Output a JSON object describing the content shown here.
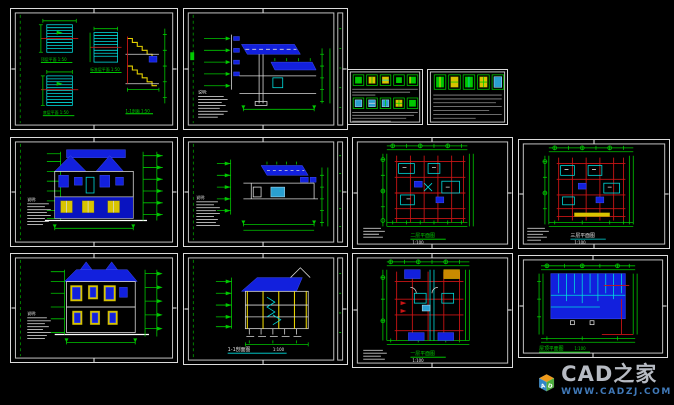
{
  "canvas": {
    "background": "#000000"
  },
  "palette": {
    "line_green": "#00c800",
    "line_cyan": "#00dcdc",
    "line_red": "#c81414",
    "fill_blue": "#1220dd",
    "fill_yellow": "#d8c400",
    "line_white": "#d9d9d9",
    "table_gray": "#8f8f8f"
  },
  "sheets": {
    "stairs": {
      "labels": [
        "顶层平面 1:50",
        "标准层平面 1:50",
        "底层平面 1:50",
        "1-1剖面 1:50"
      ]
    },
    "wall_section": {
      "note_label": "说明:"
    },
    "front_elevation": {
      "note_label": "说明:"
    },
    "section_detail": {
      "note_label": "说明:"
    },
    "plan2f": {
      "title": "二层平面图",
      "scale": "1:100"
    },
    "plan3f": {
      "title": "三层平面图",
      "scale": "1:100"
    },
    "rear_elevation": {
      "note_label": "说明:"
    },
    "section11": {
      "title": "1-1剖面图",
      "scale": "1:100"
    },
    "plan1f": {
      "title": "一层平面图",
      "scale": "1:100"
    },
    "roof_plan": {
      "title": "屋顶平面图",
      "scale": "1:100"
    }
  },
  "logo": {
    "brand": "CAD之家",
    "url": "WWW.CADZJ.COM",
    "cube": [
      "A",
      "D"
    ]
  }
}
